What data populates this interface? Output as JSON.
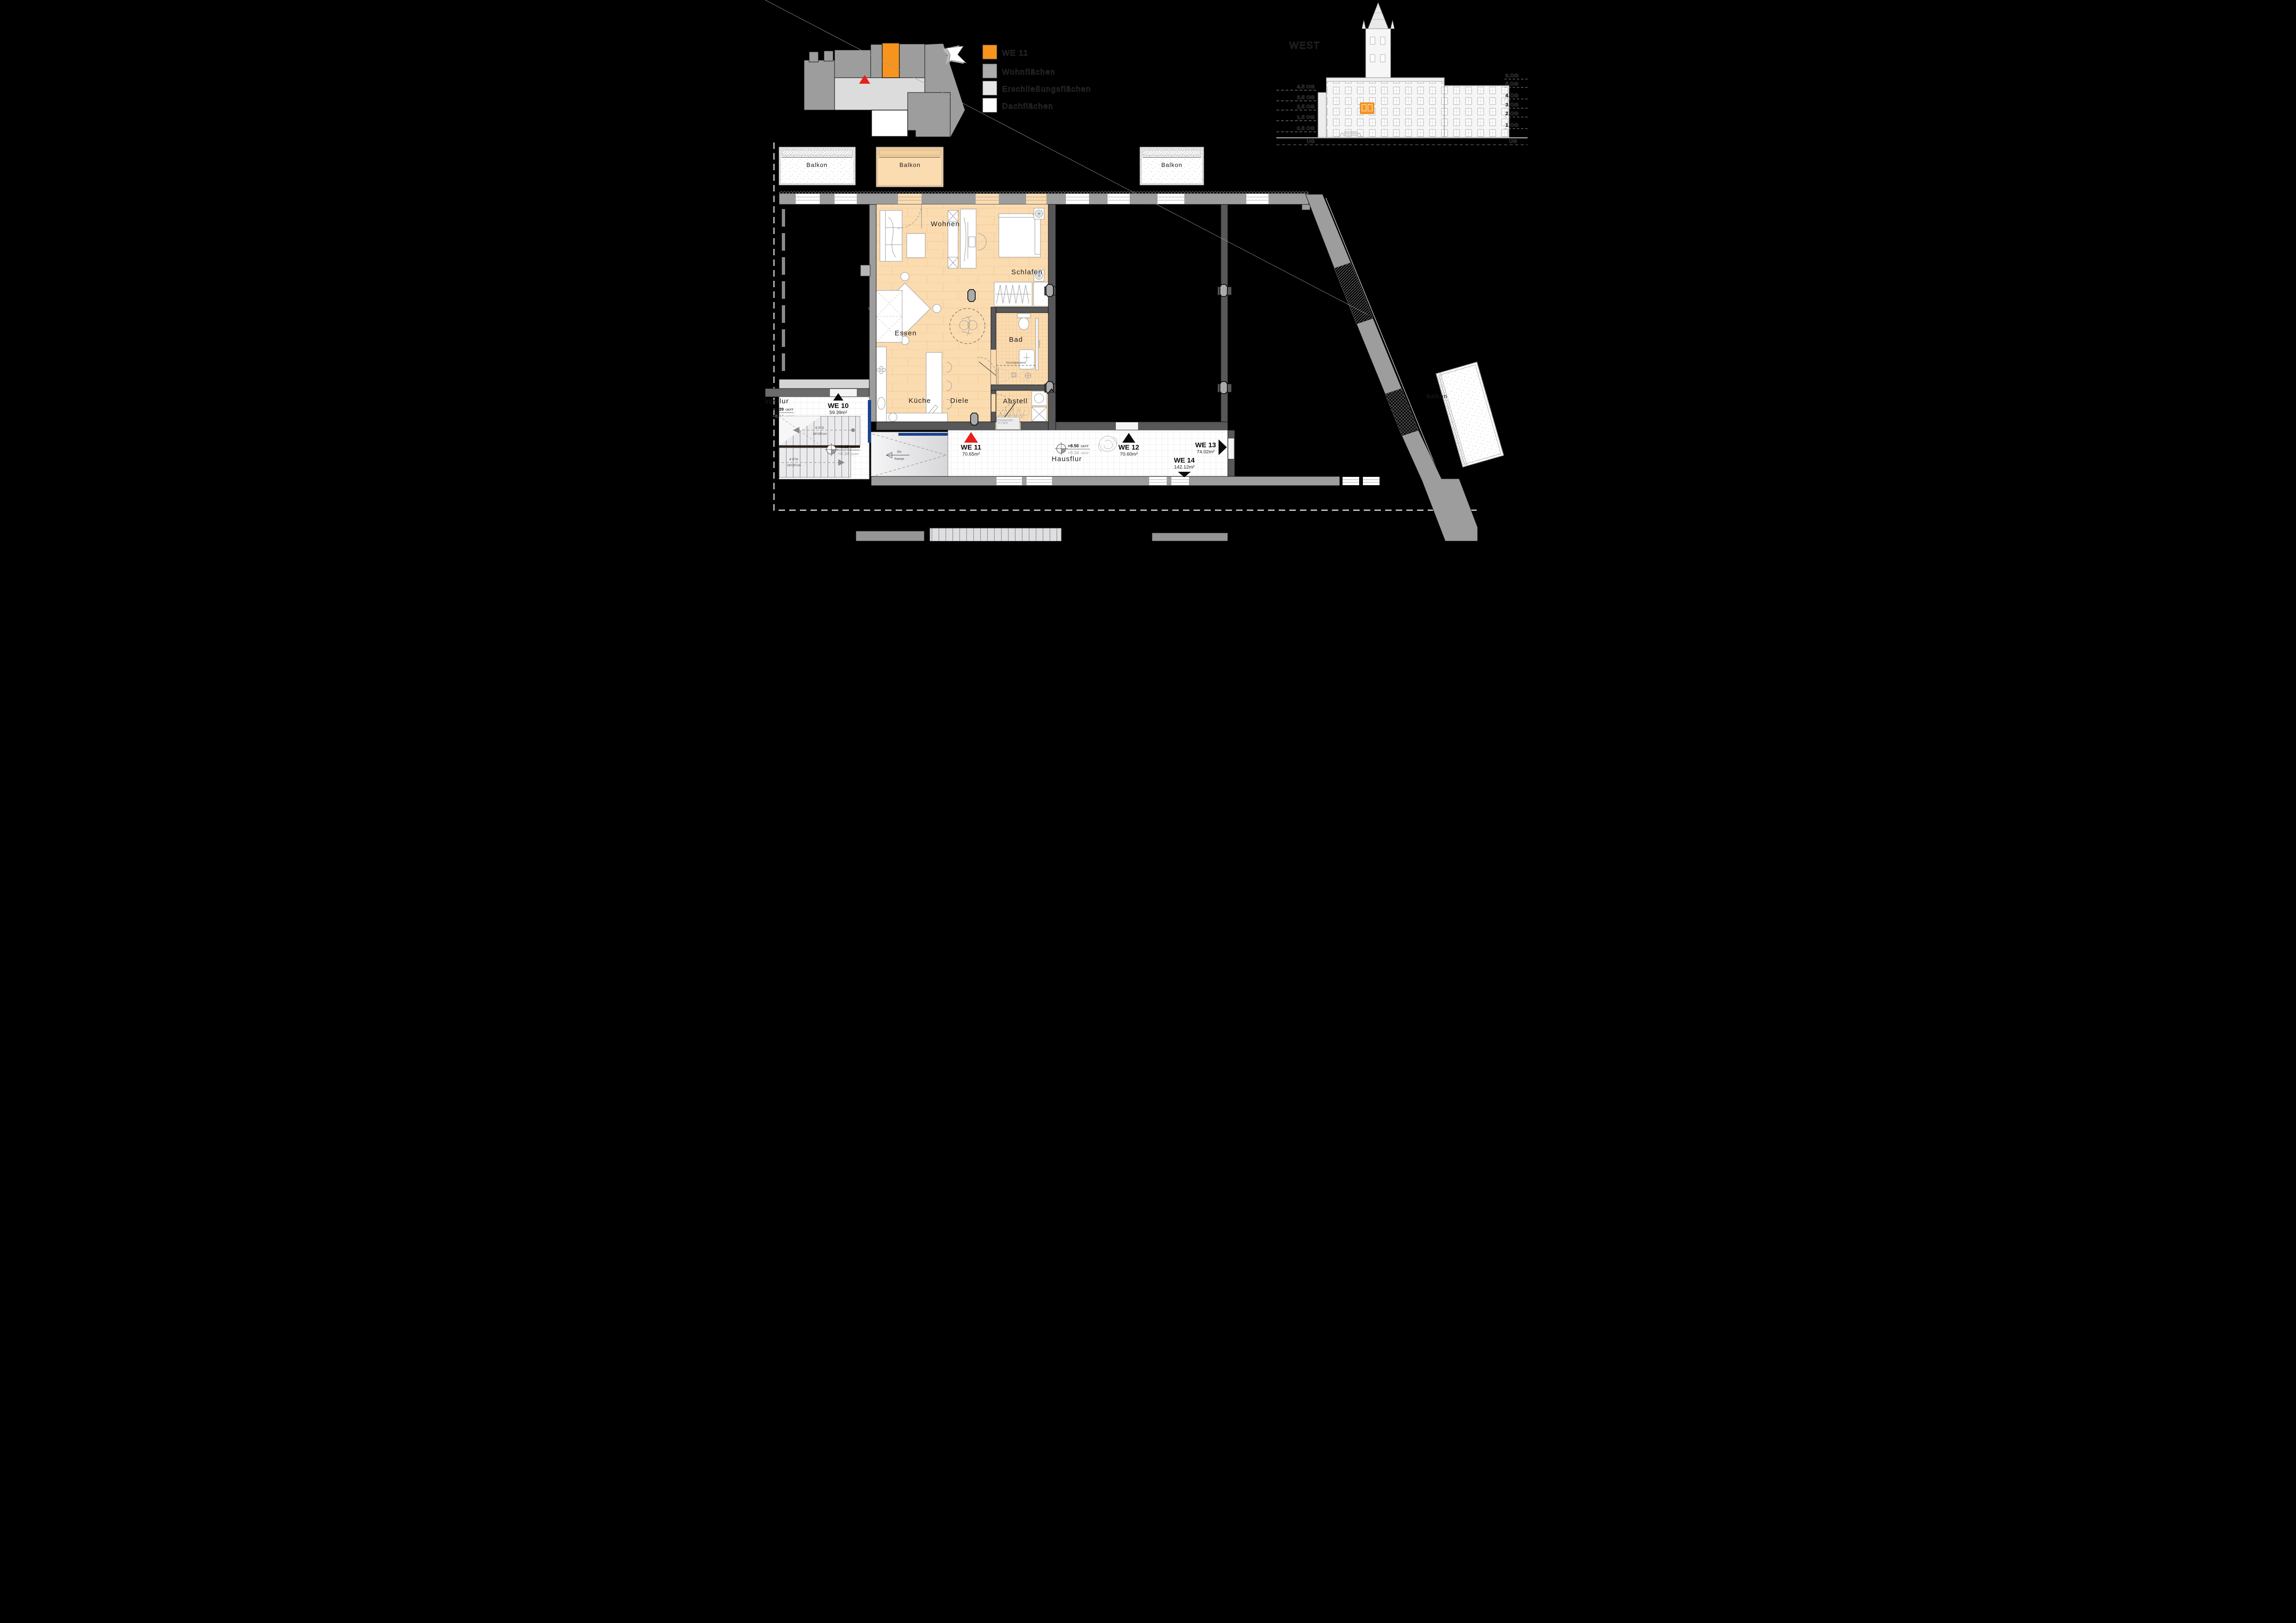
{
  "legend": {
    "items": [
      {
        "label": "WE 11",
        "swatch": "#F7941E"
      },
      {
        "label": "Wohnflächen",
        "swatch": "#ACACAC"
      },
      {
        "label": "Erschließungsflächen",
        "swatch": "#E6E6E6"
      },
      {
        "label": "Dachflächen",
        "swatch": "#FFFFFF"
      }
    ]
  },
  "elevation": {
    "title": "WEST",
    "left_levels": [
      "4.5 OG",
      "3.5 OG",
      "2.5 OG",
      "1.5 OG",
      "0.5 OG"
    ],
    "base_left": "UG",
    "right_levels": [
      "6.OG",
      "5.OG",
      "4.OG",
      "3.OG",
      "2.OG",
      "1.OG"
    ],
    "base_right": "UG"
  },
  "plan": {
    "balconies": {
      "b1": "Balkon",
      "b2": "Balkon",
      "b3": "Balkon",
      "b4": "Balkon"
    },
    "rooms": {
      "wohnen": "Wohnen",
      "schlafen": "Schlafen",
      "essen": "Essen",
      "kueche": "Küche",
      "diele": "Diele",
      "bad": "Bad",
      "abstell": "Abstell"
    },
    "corridors": {
      "left": "Hausflur",
      "bottom": "Hausflur"
    },
    "units": {
      "we10": {
        "name": "WE 10",
        "area": "59.39m²"
      },
      "we11": {
        "name": "WE 11",
        "area": "70.65m²"
      },
      "we12": {
        "name": "WE 12",
        "area": "70.60m²"
      },
      "we13": {
        "name": "WE 13",
        "area": "74.02m²"
      },
      "we14": {
        "name": "WE 14",
        "area": "142.12m²"
      }
    },
    "levels": {
      "left_clip": {
        "okff": "+8.39",
        "okff_s": "OKFF",
        "okrf": "+8.34",
        "okrf_s": "OKRF"
      },
      "landing": {
        "okff": "+8.39",
        "okff_s": "OKFF",
        "okrf": "+8.34",
        "okrf_s": "OKRF"
      },
      "corridor": {
        "okff": "+8.50",
        "okff_s": "OKFF",
        "okrf": "+8.34",
        "okrf_s": "OKRF"
      }
    },
    "stairs": {
      "upper": {
        "steps": "8 STG",
        "dim": "19⁸/25⁶cm"
      },
      "lower": {
        "steps": "8 STG",
        "dim": "19²/25⁶cm"
      }
    },
    "ramp": {
      "slope": "5%",
      "label": "Rampe"
    },
    "bath": {
      "duschglaswand": "Duschglaswand",
      "spiegel": "Spiegel",
      "duschtuchhalter": "Duschtuchhalter"
    },
    "entrance_mat": {
      "line1": "Eingangsmatte",
      "line2": "75 x 50cm"
    }
  },
  "colors": {
    "accent": "#F7941E",
    "apartment_floor": "#FBDCB0",
    "wall_dark": "#58585A",
    "wall_light": "#9D9D9D",
    "door_blue": "#16418C",
    "marker_red": "#E82019"
  }
}
